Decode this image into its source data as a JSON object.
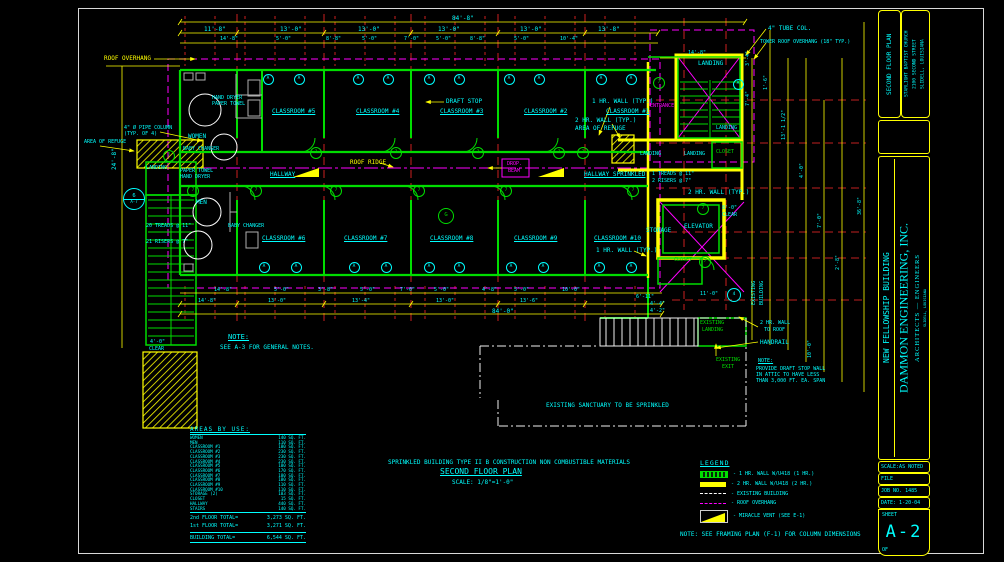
{
  "colors": {
    "cyan": "#00ffff",
    "green": "#00dd00",
    "yellow": "#ffff00",
    "magenta": "#ff00ff",
    "white": "#f0f0f0",
    "red": "#ff2a2a",
    "gray": "#b0b0b0"
  },
  "title_block": {
    "sheet_title": "SECOND FLOOR PLAN",
    "client1": "STARLIGHT BAPTIST CHURCH",
    "client2": "2100 SECOND STREET",
    "client3": "SLIDELL, LOUISIANA",
    "project": "NEW FELLOWSHIP BUILDING",
    "firm": "DAMMON ENGINEERING, INC.",
    "firm2": "ARCHITECTS — ENGINEERS",
    "firm3": "SLIDELL, LOUISIANA",
    "scale": "SCALE:AS NOTED",
    "file": "FILE",
    "job": "JOB NO. 1485",
    "date": "DATE: 1-20-04",
    "sheet": "SHEET",
    "number": "A-2",
    "of": "OF"
  },
  "areas": {
    "title": "AREAS BY USE:",
    "rows": [
      [
        "WOMEN",
        "140 SQ. FT."
      ],
      [
        "MEN",
        "110 SQ. FT."
      ],
      [
        "CLASSROOM #1",
        "180 SQ. FT."
      ],
      [
        "CLASSROOM #2",
        "230 SQ. FT."
      ],
      [
        "CLASSROOM #3",
        "230 SQ. FT."
      ],
      [
        "CLASSROOM #4",
        "230 SQ. FT."
      ],
      [
        "CLASSROOM #5",
        "180 SQ. FT."
      ],
      [
        "CLASSROOM #6",
        "170 SQ. FT."
      ],
      [
        "CLASSROOM #7",
        "180 SQ. FT."
      ],
      [
        "CLASSROOM #8",
        "180 SQ. FT."
      ],
      [
        "CLASSROOM #9",
        "110 SQ. FT."
      ],
      [
        "CLASSROOM #10",
        "110 SQ. FT."
      ],
      [
        "STORAGE (2)",
        "103 SQ. FT."
      ],
      [
        "CLOSET",
        "15 SQ. FT."
      ],
      [
        "HALLWAY",
        "440 SQ. FT."
      ],
      [
        "STAIRS",
        "140 SQ. FT."
      ]
    ],
    "totals": [
      [
        "2nd FLOOR TOTAL=",
        "3,273 SQ. FT."
      ],
      [
        "1st FLOOR TOTAL=",
        "3,271 SQ. FT."
      ]
    ],
    "building": [
      "BUILDING TOTAL=",
      "6,544 SQ. FT."
    ]
  },
  "legend": {
    "title": "LEGEND",
    "items": [
      {
        "sym": "hr1",
        "t": "- 1 HR. WALL W/U418 (1 HR.)"
      },
      {
        "sym": "hr2",
        "t": "- 2 HR. WALL W/U418 (2 HR.)"
      },
      {
        "sym": "exist",
        "t": "- EXISTING BUILDING"
      },
      {
        "sym": "roof",
        "t": "- ROOF OVERHANG"
      },
      {
        "sym": "vent",
        "t": "- MIRACLE VENT (SEE E-1)"
      }
    ]
  },
  "plan": {
    "labels": [
      {
        "t": "ROOF OVERHANG",
        "x": 104,
        "y": 56,
        "c": "yellow"
      },
      {
        "t": "84'-8\"",
        "x": 452,
        "y": 16
      },
      {
        "t": "11'-8\"",
        "x": 204,
        "y": 27
      },
      {
        "t": "13'-0\"",
        "x": 280,
        "y": 27
      },
      {
        "t": "13'-0\"",
        "x": 358,
        "y": 27
      },
      {
        "t": "13'-0\"",
        "x": 438,
        "y": 27
      },
      {
        "t": "13'-0\"",
        "x": 520,
        "y": 27
      },
      {
        "t": "13'-8\"",
        "x": 598,
        "y": 27
      },
      {
        "t": "14'-8\"",
        "x": 220,
        "y": 37,
        "fs": 5
      },
      {
        "t": "5'-0\"",
        "x": 276,
        "y": 37,
        "fs": 5
      },
      {
        "t": "8'-8\"",
        "x": 326,
        "y": 37,
        "fs": 5
      },
      {
        "t": "5'-0\"",
        "x": 362,
        "y": 37,
        "fs": 5
      },
      {
        "t": "7'-0\"",
        "x": 404,
        "y": 37,
        "fs": 5
      },
      {
        "t": "5'-0\"",
        "x": 436,
        "y": 37,
        "fs": 5
      },
      {
        "t": "8'-8\"",
        "x": 470,
        "y": 37,
        "fs": 5
      },
      {
        "t": "5'-0\"",
        "x": 514,
        "y": 37,
        "fs": 5
      },
      {
        "t": "10'-4\"",
        "x": 560,
        "y": 37,
        "fs": 5
      },
      {
        "t": "14'-8\"",
        "x": 688,
        "y": 51,
        "fs": 5
      },
      {
        "t": "4\" TUBE COL.",
        "x": 768,
        "y": 26
      },
      {
        "t": "TOWER ROOF OVERHANG (18\" TYP.)",
        "x": 760,
        "y": 40,
        "fs": 5
      },
      {
        "t": "1 HR. WALL (TYP.)",
        "x": 592,
        "y": 99
      },
      {
        "t": "CLASSROOM #5",
        "x": 272,
        "y": 109,
        "u": 1
      },
      {
        "t": "CLASSROOM #4",
        "x": 356,
        "y": 109,
        "u": 1
      },
      {
        "t": "CLASSROOM #3",
        "x": 440,
        "y": 109,
        "u": 1
      },
      {
        "t": "CLASSROOM #2",
        "x": 524,
        "y": 109,
        "u": 1
      },
      {
        "t": "CLASSROOM #1",
        "x": 606,
        "y": 109,
        "u": 1
      },
      {
        "t": "DRAFT STOP",
        "x": 446,
        "y": 99
      },
      {
        "t": "2 HR. WALL (TYP.)",
        "x": 575,
        "y": 118
      },
      {
        "t": "AREA OF REFUGE",
        "x": 575,
        "y": 126
      },
      {
        "t": "ENTRANCE",
        "x": 650,
        "y": 104,
        "c": "magenta",
        "fs": 5
      },
      {
        "t": "LANDING",
        "x": 698,
        "y": 61
      },
      {
        "t": "LANDING",
        "x": 716,
        "y": 126,
        "fs": 5
      },
      {
        "t": "LANDING",
        "x": 640,
        "y": 152,
        "fs": 5
      },
      {
        "t": "LANDING",
        "x": 684,
        "y": 152,
        "fs": 5
      },
      {
        "t": "CLOSET",
        "x": 716,
        "y": 150,
        "c": "green",
        "fs": 5
      },
      {
        "t": "HALLWAY",
        "x": 270,
        "y": 172,
        "u": 1
      },
      {
        "t": "HALLWAY SPRINKLED",
        "x": 584,
        "y": 172,
        "u": 1
      },
      {
        "t": "ROOF RIDGE",
        "x": 350,
        "y": 160,
        "c": "yellow"
      },
      {
        "t": "1 TREADS @ 11\"",
        "x": 652,
        "y": 172,
        "fs": 5
      },
      {
        "t": "2 RISERS @ 7\"",
        "x": 652,
        "y": 179,
        "fs": 5
      },
      {
        "t": "WOMEN",
        "x": 188,
        "y": 134
      },
      {
        "t": "BABY CHANGER",
        "x": 183,
        "y": 147,
        "fs": 5
      },
      {
        "t": "HAND DRYER",
        "x": 212,
        "y": 96,
        "fs": 5
      },
      {
        "t": "PAPER TOWEL",
        "x": 212,
        "y": 102,
        "fs": 5
      },
      {
        "t": "4\" Ø PIPE COLUMN",
        "x": 124,
        "y": 126,
        "fs": 5
      },
      {
        "t": "(TYP. OF 4)",
        "x": 124,
        "y": 132,
        "fs": 5
      },
      {
        "t": "AREA OF REFUGE",
        "x": 84,
        "y": 140,
        "fs": 5
      },
      {
        "t": "LANDING",
        "x": 146,
        "y": 166,
        "fs": 5
      },
      {
        "t": "PAPER TOWEL",
        "x": 180,
        "y": 169,
        "fs": 5
      },
      {
        "t": "HAND DRYER",
        "x": 180,
        "y": 175,
        "fs": 5
      },
      {
        "t": "MEN",
        "x": 196,
        "y": 200
      },
      {
        "t": "BABY CHANGER",
        "x": 228,
        "y": 224,
        "fs": 5
      },
      {
        "t": "CLASSROOM #6",
        "x": 262,
        "y": 236,
        "u": 1
      },
      {
        "t": "CLASSROOM #7",
        "x": 344,
        "y": 236,
        "u": 1
      },
      {
        "t": "CLASSROOM #8",
        "x": 430,
        "y": 236,
        "u": 1
      },
      {
        "t": "CLASSROOM #9",
        "x": 514,
        "y": 236,
        "u": 1
      },
      {
        "t": "CLASSROOM #10",
        "x": 594,
        "y": 236,
        "u": 1
      },
      {
        "t": "1 HR. WALL (TYP.)",
        "x": 596,
        "y": 248
      },
      {
        "t": "20 TREADS @ 11\"",
        "x": 146,
        "y": 224,
        "fs": 5
      },
      {
        "t": "21 RISERS @ 7\"",
        "x": 146,
        "y": 240,
        "fs": 5
      },
      {
        "t": "4'-0\"",
        "x": 150,
        "y": 340,
        "fs": 5
      },
      {
        "t": "CLEAR",
        "x": 149,
        "y": 347,
        "fs": 5
      },
      {
        "t": "24'-8\"",
        "x": 112,
        "y": 170,
        "r": -90
      },
      {
        "t": "2 HR. WALL (TYP.)",
        "x": 688,
        "y": 190
      },
      {
        "t": "STORAGE",
        "x": 646,
        "y": 228
      },
      {
        "t": "ELEVATOR",
        "x": 684,
        "y": 224
      },
      {
        "t": "8'-0\"",
        "x": 722,
        "y": 206,
        "fs": 5
      },
      {
        "t": "CLEAR",
        "x": 722,
        "y": 213,
        "fs": 5
      },
      {
        "t": "CLOSET",
        "x": 674,
        "y": 258,
        "c": "green",
        "fs": 5
      },
      {
        "t": "11'-0\"",
        "x": 700,
        "y": 292,
        "fs": 5
      },
      {
        "t": "4'-4\"",
        "x": 650,
        "y": 302,
        "fs": 5
      },
      {
        "t": "4'-2\"",
        "x": 650,
        "y": 309,
        "fs": 5
      },
      {
        "t": "6'-11\"",
        "x": 636,
        "y": 295,
        "fs": 5
      },
      {
        "t": "EXISTING",
        "x": 700,
        "y": 321,
        "c": "green",
        "fs": 5
      },
      {
        "t": "LANDING",
        "x": 702,
        "y": 328,
        "c": "green",
        "fs": 5
      },
      {
        "t": "EXISTING",
        "x": 716,
        "y": 358,
        "c": "green",
        "fs": 5
      },
      {
        "t": "EXIT",
        "x": 722,
        "y": 365,
        "c": "green",
        "fs": 5
      },
      {
        "t": "HANDRAIL",
        "x": 760,
        "y": 340
      },
      {
        "t": "2 HR. WALL",
        "x": 760,
        "y": 321,
        "fs": 5
      },
      {
        "t": "TO ROOF",
        "x": 764,
        "y": 328,
        "fs": 5
      },
      {
        "t": "NOTE:",
        "x": 758,
        "y": 359,
        "u": 1,
        "fs": 5
      },
      {
        "t": "PROVIDE DRAFT STOP WALL",
        "x": 756,
        "y": 367,
        "fs": 5
      },
      {
        "t": "IN ATTIC TO HAVE LESS",
        "x": 756,
        "y": 373,
        "fs": 5
      },
      {
        "t": "THAN 3,000 FT. EA. SPAN",
        "x": 756,
        "y": 379,
        "fs": 5
      },
      {
        "t": "EXISTING SANCTUARY TO BE SPRINKLED",
        "x": 546,
        "y": 403
      },
      {
        "t": "EXISTING",
        "x": 752,
        "y": 305,
        "r": -90,
        "fs": 5
      },
      {
        "t": "BUILDING",
        "x": 760,
        "y": 305,
        "r": -90,
        "fs": 5
      },
      {
        "t": "10'-0\"",
        "x": 808,
        "y": 358,
        "r": -90,
        "fs": 5
      },
      {
        "t": "3'-4\"",
        "x": 746,
        "y": 66,
        "r": -90,
        "fs": 5
      },
      {
        "t": "7'-4\"",
        "x": 746,
        "y": 106,
        "r": -90,
        "fs": 5
      },
      {
        "t": "1'-6\"",
        "x": 764,
        "y": 90,
        "r": -90,
        "fs": 5
      },
      {
        "t": "13'-1 1/2\"",
        "x": 782,
        "y": 140,
        "r": -90,
        "fs": 5
      },
      {
        "t": "4'-0\"",
        "x": 800,
        "y": 178,
        "r": -90,
        "fs": 5
      },
      {
        "t": "7'-0\"",
        "x": 818,
        "y": 228,
        "r": -90,
        "fs": 5
      },
      {
        "t": "2'-8\"",
        "x": 836,
        "y": 270,
        "r": -90,
        "fs": 5
      },
      {
        "t": "36'-8\"",
        "x": 858,
        "y": 215,
        "r": -90,
        "fs": 5
      },
      {
        "t": "NOTE:",
        "x": 228,
        "y": 334,
        "u": 1,
        "fs": 7
      },
      {
        "t": "SEE A-3 FOR GENERAL NOTES.",
        "x": 220,
        "y": 345
      },
      {
        "t": "14'-8\"",
        "x": 214,
        "y": 288,
        "fs": 5
      },
      {
        "t": "5'-0\"",
        "x": 274,
        "y": 288,
        "fs": 5
      },
      {
        "t": "3'-8\"",
        "x": 318,
        "y": 288,
        "fs": 5
      },
      {
        "t": "5'-0\"",
        "x": 360,
        "y": 288,
        "fs": 5
      },
      {
        "t": "7'-0\"",
        "x": 400,
        "y": 288,
        "fs": 5
      },
      {
        "t": "5'-0\"",
        "x": 434,
        "y": 288,
        "fs": 5
      },
      {
        "t": "4'-8\"",
        "x": 482,
        "y": 288,
        "fs": 5
      },
      {
        "t": "5'-0\"",
        "x": 514,
        "y": 288,
        "fs": 5
      },
      {
        "t": "10'-0\"",
        "x": 562,
        "y": 288,
        "fs": 5
      },
      {
        "t": "14'-8\"",
        "x": 198,
        "y": 299,
        "fs": 5
      },
      {
        "t": "13'-0\"",
        "x": 268,
        "y": 299,
        "fs": 5
      },
      {
        "t": "13'-4\"",
        "x": 352,
        "y": 299,
        "fs": 5
      },
      {
        "t": "13'-0\"",
        "x": 436,
        "y": 299,
        "fs": 5
      },
      {
        "t": "13'-6\"",
        "x": 520,
        "y": 299,
        "fs": 5
      },
      {
        "t": "84'-0\"",
        "x": 492,
        "y": 309
      },
      {
        "t": "DROP.",
        "x": 507,
        "y": 162,
        "c": "magenta",
        "fs": 5
      },
      {
        "t": "BEAM",
        "x": 508,
        "y": 169,
        "c": "magenta",
        "fs": 5
      },
      {
        "t": "SPRINKLED BUILDING TYPE II B CONSTRUCTION NON COMBUSTIBLE MATERIALS",
        "x": 388,
        "y": 460
      },
      {
        "t": "SECOND FLOOR PLAN",
        "x": 440,
        "y": 468,
        "fs": 8,
        "u": 1
      },
      {
        "t": "SCALE: 1/8\"=1'-0\"",
        "x": 452,
        "y": 480
      },
      {
        "t": "NOTE: SEE FRAMING PLAN (F-1) FOR COLUMN DIMENSIONS",
        "x": 680,
        "y": 532
      }
    ],
    "tags": [
      {
        "t": "7",
        "x": 168,
        "y": 155
      },
      {
        "t": "7",
        "x": 192,
        "y": 190
      },
      {
        "t": "7",
        "x": 255,
        "y": 190
      },
      {
        "t": "7",
        "x": 315,
        "y": 152
      },
      {
        "t": "7",
        "x": 335,
        "y": 190
      },
      {
        "t": "7",
        "x": 395,
        "y": 152
      },
      {
        "t": "7",
        "x": 418,
        "y": 190
      },
      {
        "t": "7",
        "x": 477,
        "y": 152
      },
      {
        "t": "7",
        "x": 505,
        "y": 190
      },
      {
        "t": "7",
        "x": 558,
        "y": 152
      },
      {
        "t": "7",
        "x": 582,
        "y": 152
      },
      {
        "t": "7",
        "x": 632,
        "y": 190
      },
      {
        "t": "7",
        "x": 658,
        "y": 82
      },
      {
        "t": "7",
        "x": 702,
        "y": 208
      },
      {
        "t": "7",
        "x": 704,
        "y": 261
      },
      {
        "t": "A",
        "x": 267,
        "y": 78,
        "c": "cyan",
        "r": 4.5
      },
      {
        "t": "A",
        "x": 298,
        "y": 78,
        "c": "cyan",
        "r": 4.5
      },
      {
        "t": "A",
        "x": 357,
        "y": 78,
        "c": "cyan",
        "r": 4.5
      },
      {
        "t": "A",
        "x": 387,
        "y": 78,
        "c": "cyan",
        "r": 4.5
      },
      {
        "t": "A",
        "x": 428,
        "y": 78,
        "c": "cyan",
        "r": 4.5
      },
      {
        "t": "A",
        "x": 458,
        "y": 78,
        "c": "cyan",
        "r": 4.5
      },
      {
        "t": "A",
        "x": 508,
        "y": 78,
        "c": "cyan",
        "r": 4.5
      },
      {
        "t": "A",
        "x": 538,
        "y": 78,
        "c": "cyan",
        "r": 4.5
      },
      {
        "t": "A",
        "x": 600,
        "y": 78,
        "c": "cyan",
        "r": 4.5
      },
      {
        "t": "A",
        "x": 630,
        "y": 78,
        "c": "cyan",
        "r": 4.5
      },
      {
        "t": "A",
        "x": 737,
        "y": 83,
        "c": "cyan",
        "r": 4.5
      },
      {
        "t": "A",
        "x": 263,
        "y": 266,
        "c": "cyan",
        "r": 4.5
      },
      {
        "t": "A",
        "x": 295,
        "y": 266,
        "c": "cyan",
        "r": 4.5
      },
      {
        "t": "A",
        "x": 353,
        "y": 266,
        "c": "cyan",
        "r": 4.5
      },
      {
        "t": "A",
        "x": 385,
        "y": 266,
        "c": "cyan",
        "r": 4.5
      },
      {
        "t": "A",
        "x": 428,
        "y": 266,
        "c": "cyan",
        "r": 4.5
      },
      {
        "t": "A",
        "x": 458,
        "y": 266,
        "c": "cyan",
        "r": 4.5
      },
      {
        "t": "A",
        "x": 510,
        "y": 266,
        "c": "cyan",
        "r": 4.5
      },
      {
        "t": "A",
        "x": 542,
        "y": 266,
        "c": "cyan",
        "r": 4.5
      },
      {
        "t": "A",
        "x": 598,
        "y": 266,
        "c": "cyan",
        "r": 4.5
      },
      {
        "t": "A",
        "x": 630,
        "y": 266,
        "c": "cyan",
        "r": 4.5
      },
      {
        "t": "G",
        "x": 445,
        "y": 215,
        "c": "green",
        "r": 7
      },
      {
        "t": "4",
        "x": 733,
        "y": 294,
        "c": "cyan",
        "r": 6
      },
      {
        "t": "6",
        "b": "A-7",
        "x": 133,
        "y": 198,
        "c": "cyan",
        "r": 10
      }
    ]
  }
}
